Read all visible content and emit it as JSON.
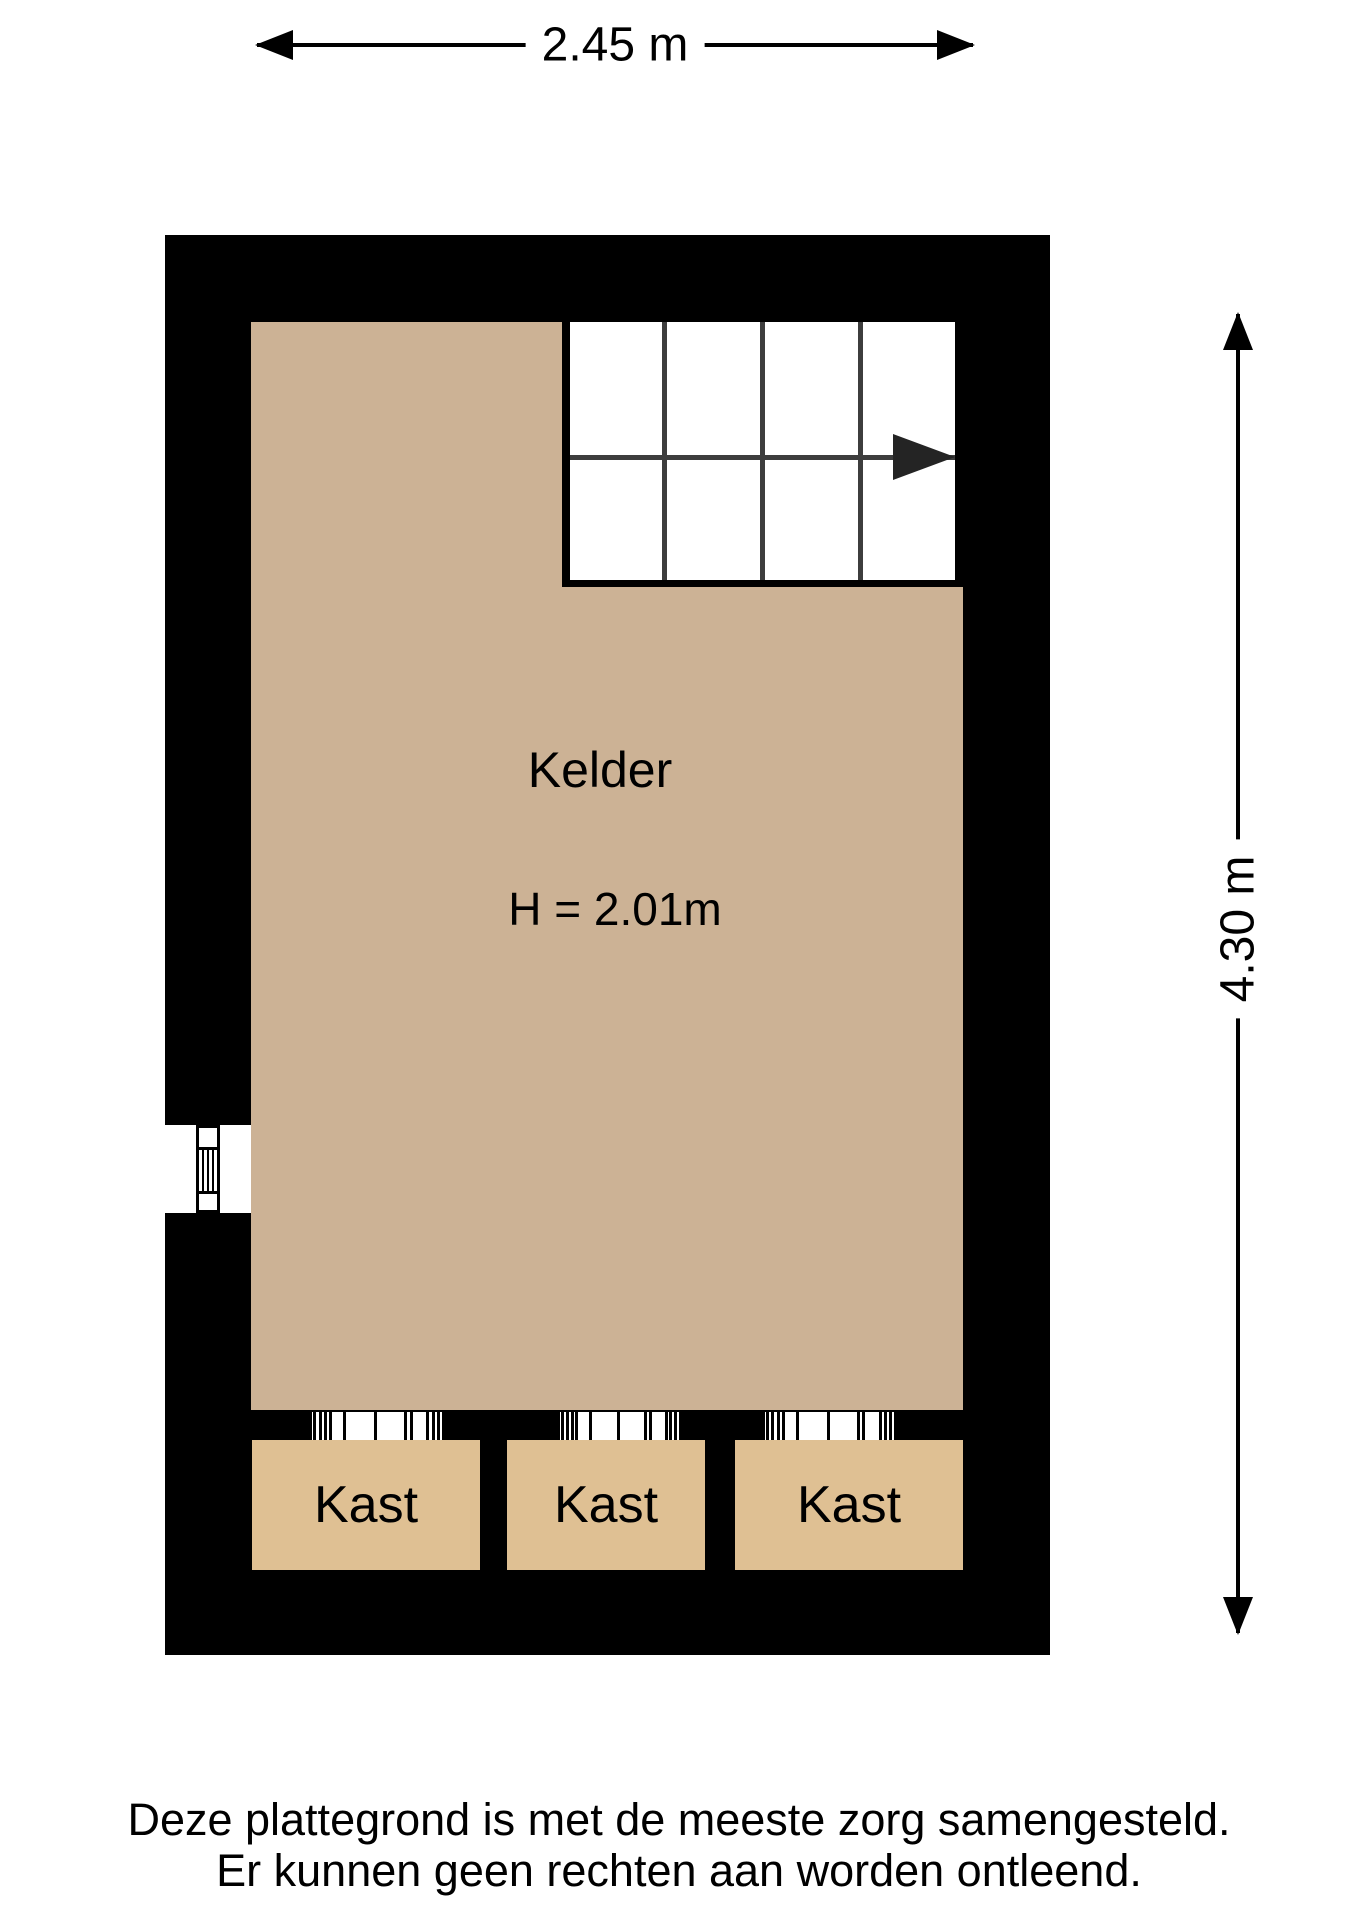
{
  "dimensions": {
    "width": "2.45 m",
    "height": "4.30 m"
  },
  "rooms": {
    "main": {
      "name": "Kelder",
      "ceiling_height": "H = 2.01m"
    },
    "closets": [
      {
        "label": "Kast"
      },
      {
        "label": "Kast"
      },
      {
        "label": "Kast"
      }
    ]
  },
  "footer": {
    "line1": "Deze plattegrond is met de meeste zorg samengesteld.",
    "line2": "Er kunnen geen rechten aan worden ontleend."
  },
  "colors": {
    "background": "#ffffff",
    "wall": "#000000",
    "floor": "#ccb295",
    "closet": "#dfc093",
    "stair-line": "#3d3d3d"
  }
}
